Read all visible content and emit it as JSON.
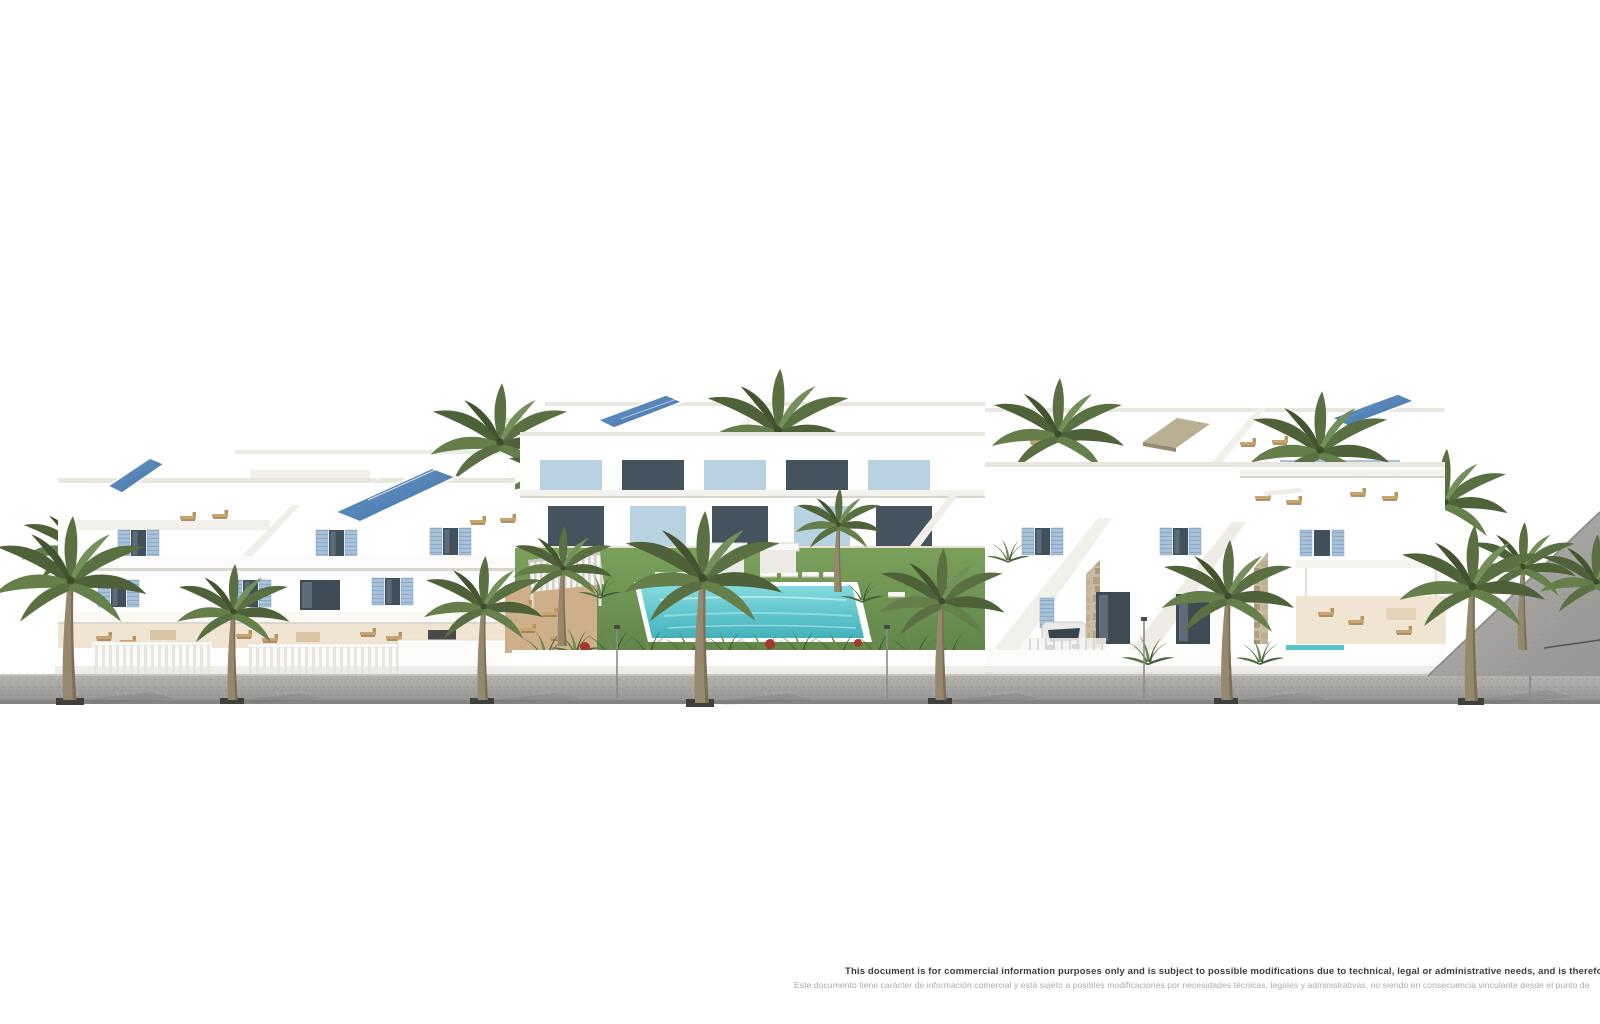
{
  "scene": {
    "type": "architectural-3d-render",
    "subject": "White Mediterranean residential complex with blue shutters, rooftop solar panels, palm trees, central garden with swimming pool and sun loungers, street with palms in front"
  },
  "disclaimer": {
    "line1_en": "This document is for commercial information purposes only and is subject to possible modifications due to technical, legal or administrative needs, and is therefore not contra",
    "line2_es": "Este documento tiene carácter de información comercial y está sujeto a posibles modificaciones por necesidades técnicas, legales y administrativas, no siendo en consecuencia vinculante desde el punto de"
  },
  "palette": {
    "background": "#ffffff",
    "facade_white": "#ffffff",
    "facade_shade": "#e9e5dc",
    "terrace_floor": "#ead9c4",
    "shutter_blue": "#9dbad5",
    "glass_dark": "#3f4b54",
    "solar_panel_blue": "#49759f",
    "lawn_green": "#6d9150",
    "pool_teal": "#5cc6ce",
    "palm_green": "#55683f",
    "palm_trunk": "#8f7f63",
    "street_gray": "#a5a5a5",
    "curb_gray": "#7c7c7c",
    "stone_tan": "#c2b39a",
    "lounger_wood": "#c8a470",
    "text_dark": "#3d3d3d",
    "text_light": "#a9a9a9"
  }
}
